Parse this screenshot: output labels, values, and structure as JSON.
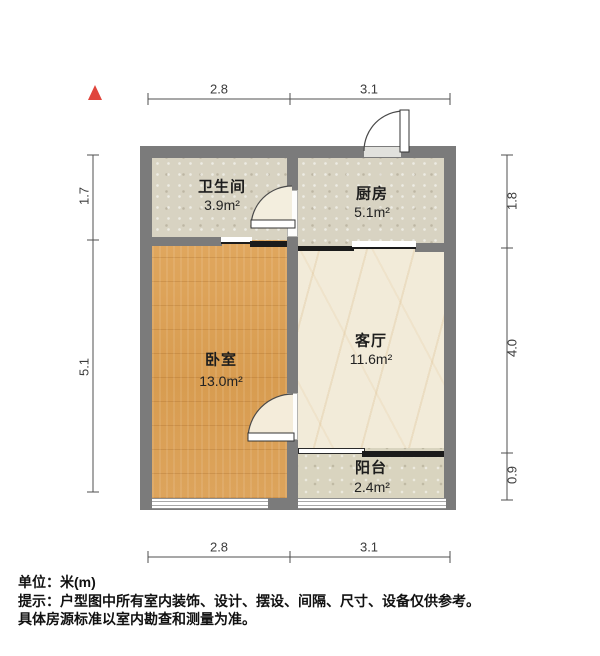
{
  "rooms": [
    {
      "id": "bathroom",
      "name": "卫生间",
      "area": "3.9m²"
    },
    {
      "id": "kitchen",
      "name": "厨房",
      "area": "5.1m²"
    },
    {
      "id": "bedroom",
      "name": "卧室",
      "area": "13.0m²"
    },
    {
      "id": "living",
      "name": "客厅",
      "area": "11.6m²"
    },
    {
      "id": "balcony",
      "name": "阳台",
      "area": "2.4m²"
    }
  ],
  "dimensions": {
    "unit": "m",
    "top": [
      "2.8",
      "3.1"
    ],
    "bottom": [
      "2.8",
      "3.1"
    ],
    "left": [
      "1.7",
      "5.1"
    ],
    "right": [
      "1.8",
      "4.0",
      "0.9"
    ]
  },
  "icons": {
    "north_arrow": "red-triangle-north"
  },
  "footer": {
    "line1": "单位：米(m)",
    "line2": "提示：户型图中所有室内装饰、设计、摆设、间隔、尺寸、设备仅供参考。",
    "line3": "具体房源标准以室内勘查和测量为准。"
  },
  "colors": {
    "wall": "#7b7b7b",
    "wood_floor": "#dba158",
    "marble_floor": "#f2ebd9",
    "tile_floor": "#d8d3c2",
    "balcony_floor": "#d9d4bf",
    "north_arrow": "#e0453d",
    "dimension_line": "#4f4f4f"
  }
}
